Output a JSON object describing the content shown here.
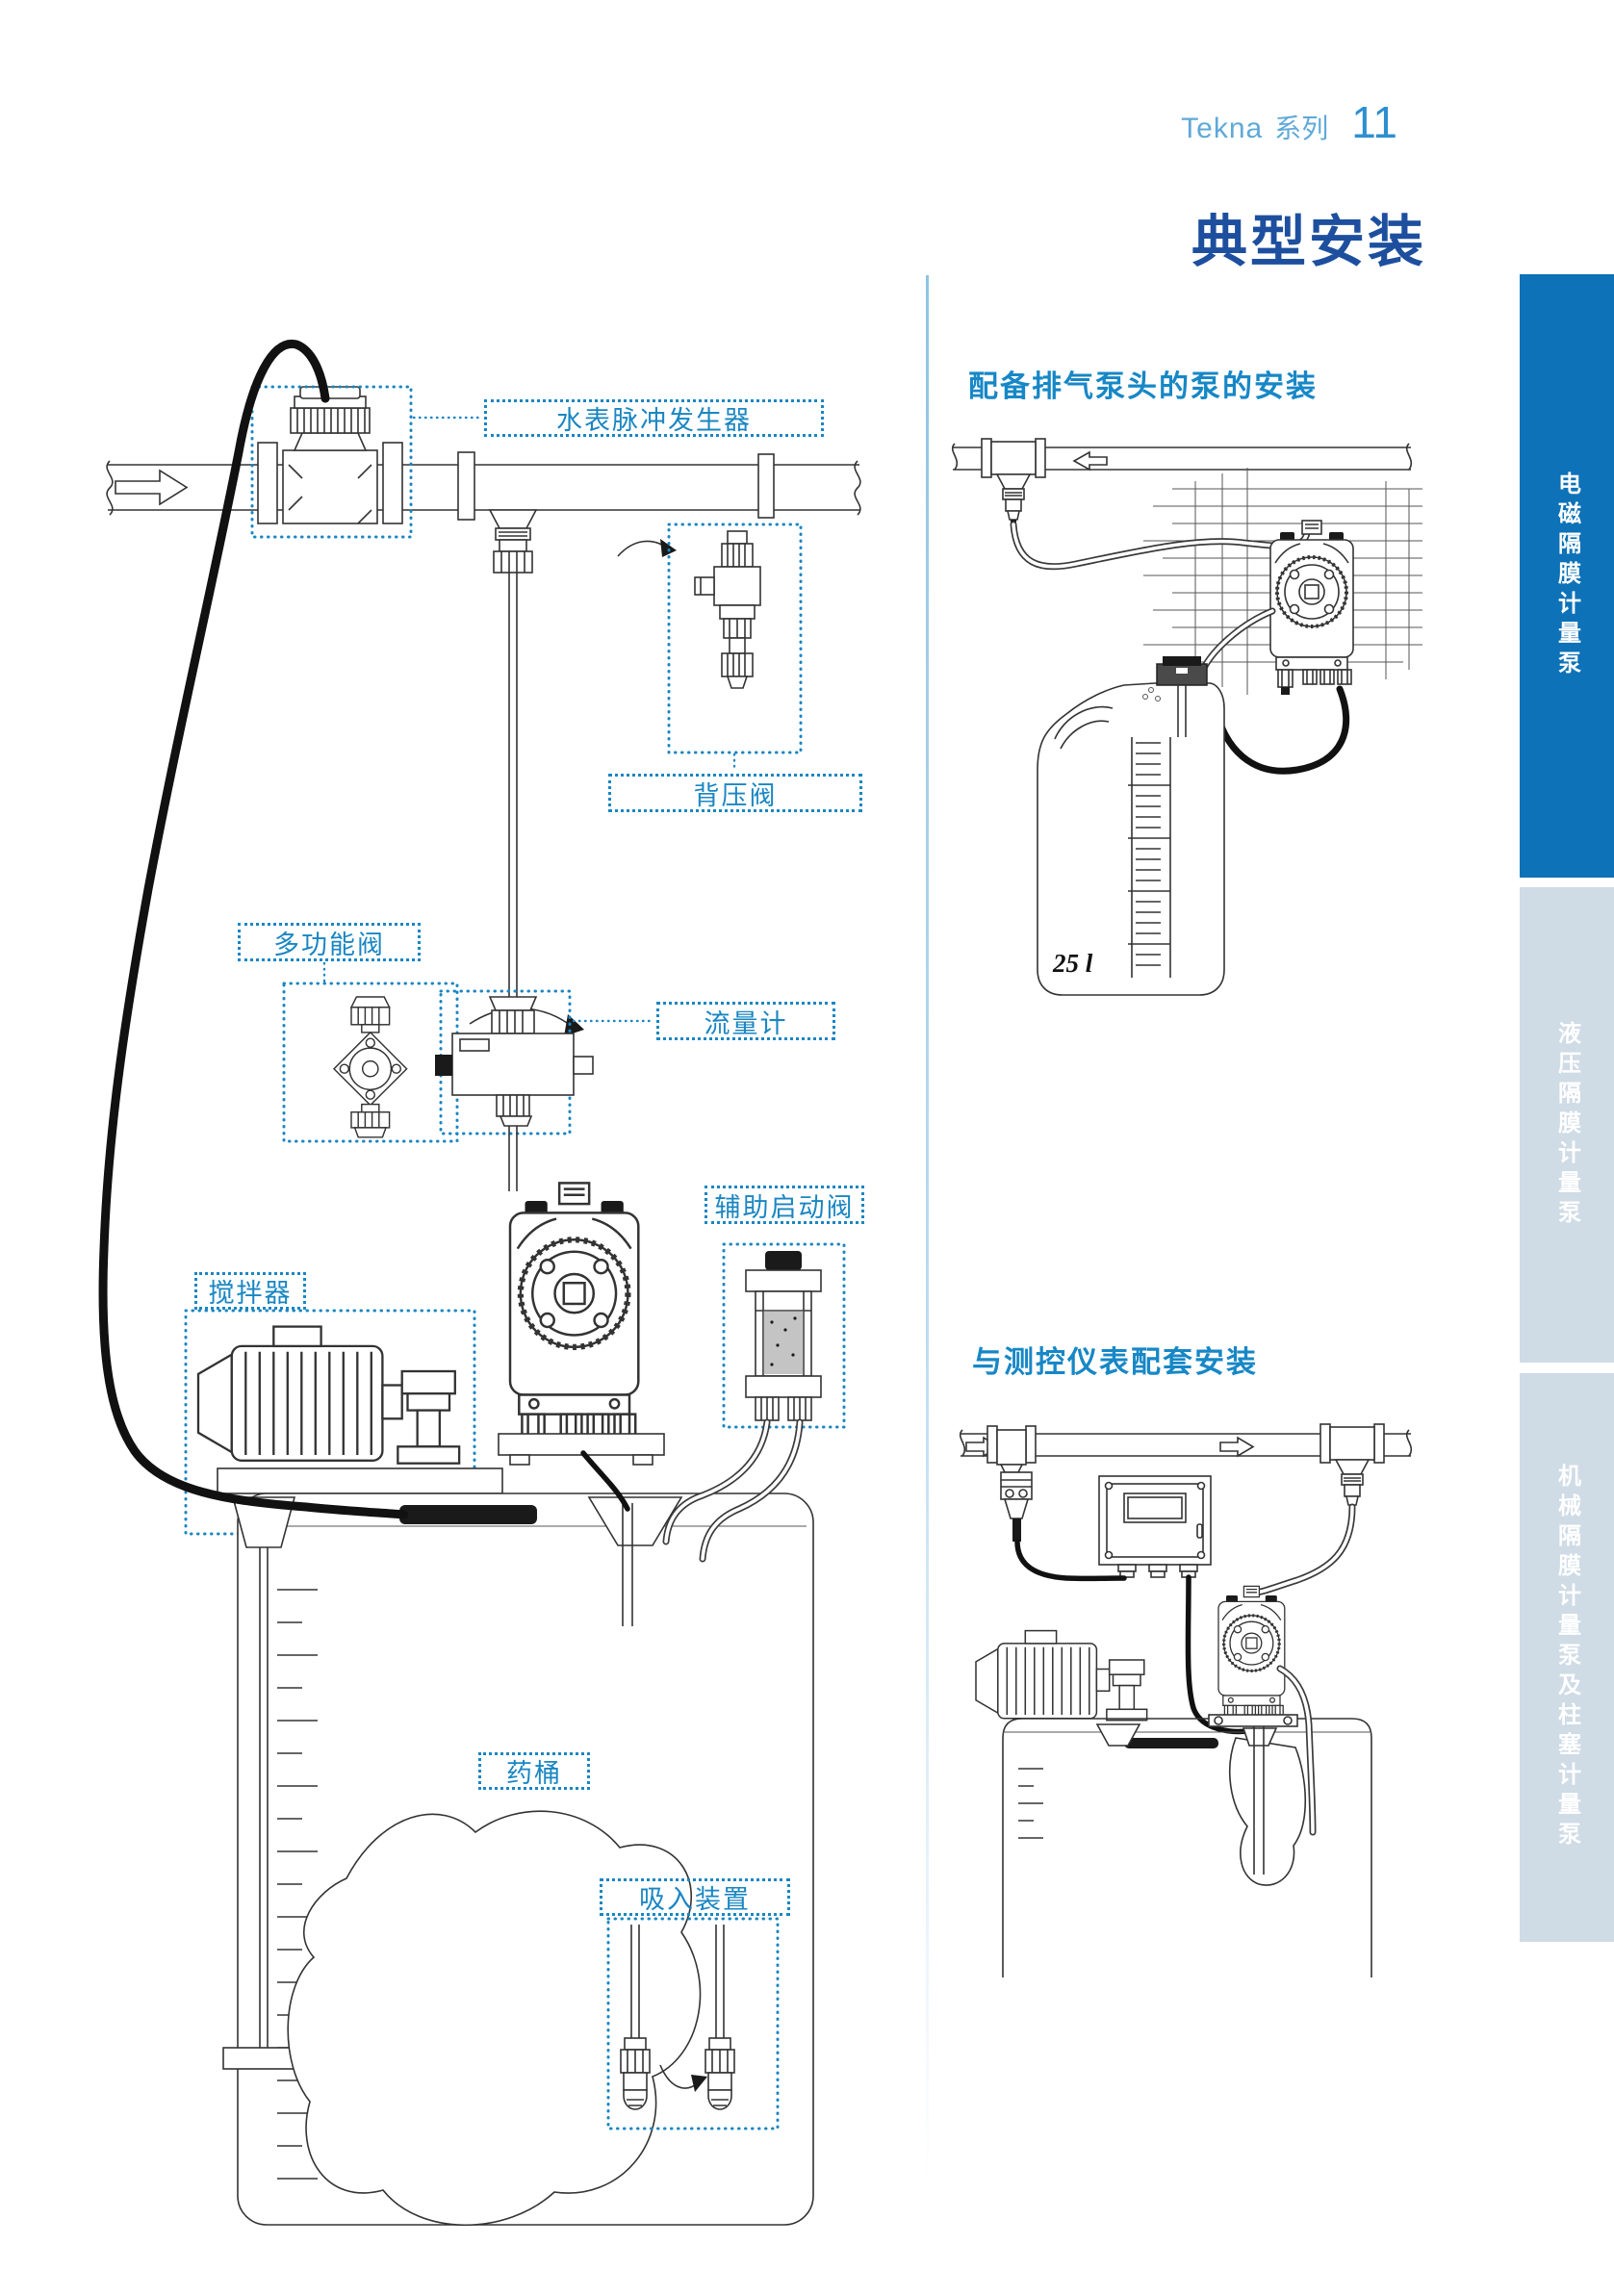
{
  "header": {
    "series": "Tekna",
    "series_label": "系列",
    "page_number": "11"
  },
  "title": "典型安装",
  "sidebar_tabs": [
    {
      "label": "电磁隔膜计量泵",
      "state": "active"
    },
    {
      "label": "液压隔膜计量泵",
      "state": "inactive"
    },
    {
      "label": "机械隔膜计量泵及柱塞计量泵",
      "state": "inactive"
    }
  ],
  "left_diagram": {
    "labels": {
      "water_meter_pulse_generator": "水表脉冲发生器",
      "back_pressure_valve": "背压阀",
      "multifunction_valve": "多功能阀",
      "flow_meter": "流量计",
      "auxiliary_start_valve": "辅助启动阀",
      "mixer": "搅拌器",
      "chemical_tank": "药桶",
      "suction_device": "吸入装置"
    }
  },
  "right_column": {
    "section1": {
      "heading": "配备排气泵头的泵的安装",
      "tank_label": "25 l"
    },
    "section2": {
      "heading": "与测控仪表配套安装"
    }
  },
  "colors": {
    "accent_blue": "#1787c6",
    "title_blue": "#1d4f9e",
    "tab_active_blue": "#0d72b7",
    "tab_inactive_gray": "#cfdbe5",
    "header_light_blue": "#5fa9d8",
    "page_number_blue": "#2e8fd0",
    "line_art": "#333333"
  }
}
